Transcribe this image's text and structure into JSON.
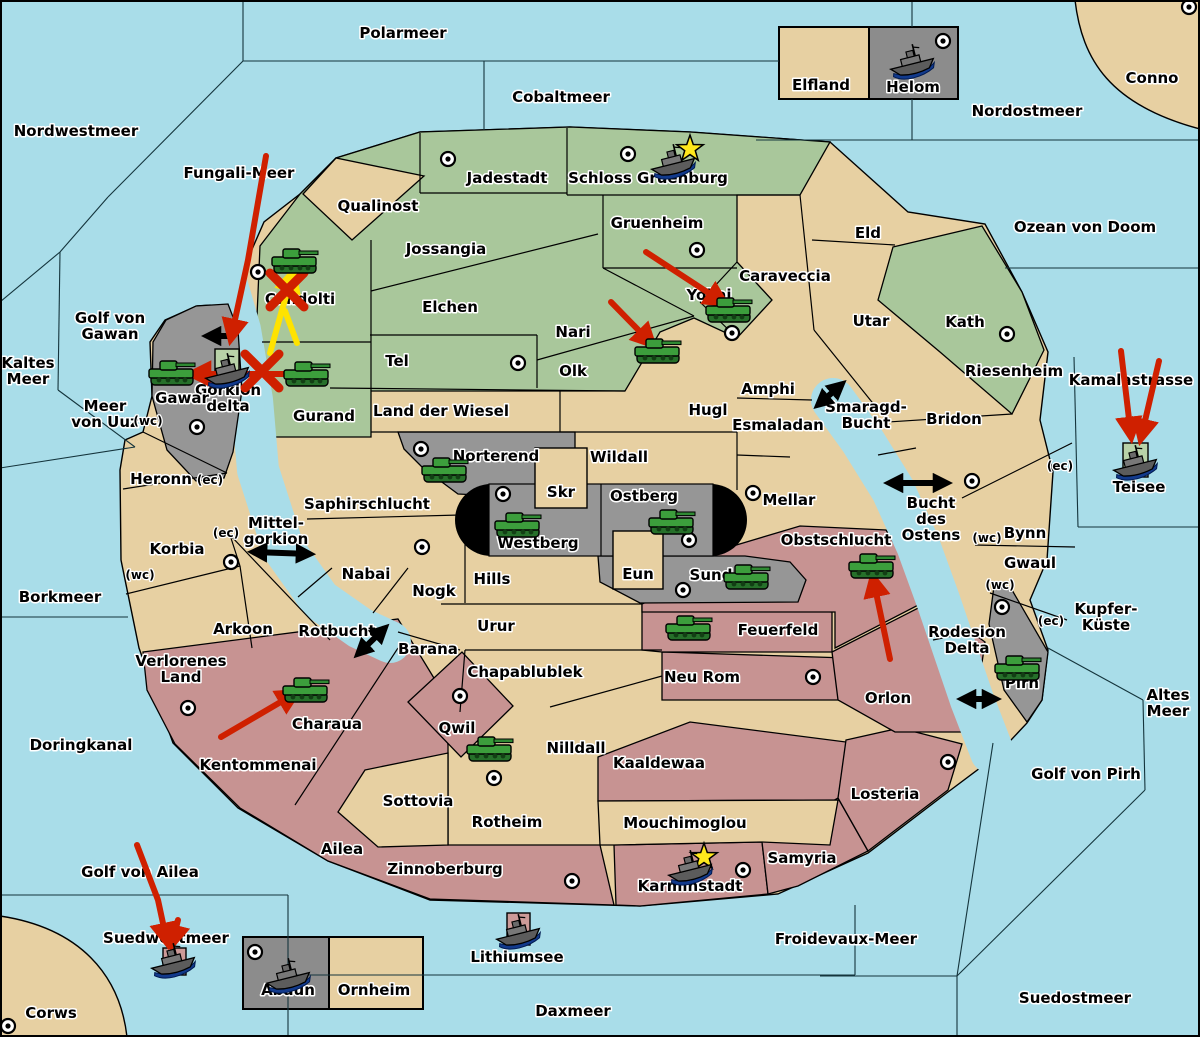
{
  "map": {
    "title": "Diplomacy variant game map",
    "colors": {
      "sea": "#a9dde9",
      "land_tan": "#e7d0a2",
      "land_green": "#a9c79b",
      "land_pink": "#c79392",
      "land_gray": "#969696",
      "inset_gray": "#8c8c8c",
      "box_green": "#b8d2a8",
      "box_pink": "#cc9a98",
      "capsule_black": "#000000",
      "arrow_red": "#cf2000",
      "arrow_yellow": "#ffe300",
      "arrow_black": "#000000",
      "star_yellow": "#ffe81c",
      "unit_green": "#3c9e3c",
      "ship_gray": "#6a6a6a",
      "border": "#000000"
    },
    "sea_labels": [
      {
        "name": "Polarmeer",
        "x": 403,
        "y": 38
      },
      {
        "name": "Cobaltmeer",
        "x": 561,
        "y": 102
      },
      {
        "name": "Nordwestmeer",
        "x": 76,
        "y": 136
      },
      {
        "name": "Nordostmeer",
        "x": 1027,
        "y": 116
      },
      {
        "name": "Fungali-Meer",
        "x": 239,
        "y": 178
      },
      {
        "name": "Ozean von Doom",
        "x": 1085,
        "y": 232
      },
      {
        "name": "Golf von Gawan",
        "x": 110,
        "y": 323,
        "lines": [
          "Golf von",
          "Gawan"
        ]
      },
      {
        "name": "Kaltes Meer",
        "x": 28,
        "y": 368,
        "lines": [
          "Kaltes",
          "Meer"
        ]
      },
      {
        "name": "Meer von Uuz",
        "x": 105,
        "y": 411,
        "lines": [
          "Meer",
          "von Uuz"
        ]
      },
      {
        "name": "Kamalastrasse",
        "x": 1131,
        "y": 385
      },
      {
        "name": "Teisee",
        "x": 1139,
        "y": 492
      },
      {
        "name": "Borkmeer",
        "x": 60,
        "y": 602
      },
      {
        "name": "Mittel-gorkion",
        "x": 276,
        "y": 528,
        "lines": [
          "Mittel-",
          "gorkion"
        ]
      },
      {
        "name": "Smaragd-Bucht",
        "x": 866,
        "y": 412,
        "lines": [
          "Smaragd-",
          "Bucht"
        ]
      },
      {
        "name": "Bucht des Ostens",
        "x": 931,
        "y": 508,
        "lines": [
          "Bucht",
          "des",
          "Ostens"
        ]
      },
      {
        "name": "Rotbucht",
        "x": 337,
        "y": 636
      },
      {
        "name": "Doringkanal",
        "x": 81,
        "y": 750
      },
      {
        "name": "Golf von Pirh",
        "x": 1086,
        "y": 779
      },
      {
        "name": "Kupfer-Kueste",
        "x": 1106,
        "y": 614,
        "lines": [
          "Kupfer-",
          "Küste"
        ]
      },
      {
        "name": "Altes Meer",
        "x": 1168,
        "y": 700,
        "lines": [
          "Altes",
          "Meer"
        ]
      },
      {
        "name": "Golf von Ailea",
        "x": 140,
        "y": 877
      },
      {
        "name": "Suedwestmeer",
        "x": 166,
        "y": 943
      },
      {
        "name": "Froidevaux-Meer",
        "x": 846,
        "y": 944
      },
      {
        "name": "Suedostmeer",
        "x": 1075,
        "y": 1003
      },
      {
        "name": "Daxmeer",
        "x": 573,
        "y": 1016
      },
      {
        "name": "Lithiumsee",
        "x": 517,
        "y": 962
      },
      {
        "name": "Rodesion Delta",
        "x": 967,
        "y": 637,
        "lines": [
          "Rodesion",
          "Delta"
        ]
      },
      {
        "name": "Gorkion delta",
        "x": 228,
        "y": 395,
        "lines": [
          "Gorkion",
          "delta"
        ]
      },
      {
        "name": "Conno",
        "x": 1152,
        "y": 83
      },
      {
        "name": "Corws",
        "x": 51,
        "y": 1018
      }
    ],
    "land_labels": [
      {
        "name": "Jadestadt",
        "x": 507,
        "y": 183
      },
      {
        "name": "Schloss Gruenburg",
        "x": 648,
        "y": 183
      },
      {
        "name": "Qualinost",
        "x": 378,
        "y": 211
      },
      {
        "name": "Jossangia",
        "x": 446,
        "y": 254
      },
      {
        "name": "Elchen",
        "x": 450,
        "y": 312
      },
      {
        "name": "Gruenheim",
        "x": 657,
        "y": 228
      },
      {
        "name": "Nari",
        "x": 573,
        "y": 337
      },
      {
        "name": "Olk",
        "x": 573,
        "y": 376
      },
      {
        "name": "Tel",
        "x": 397,
        "y": 366
      },
      {
        "name": "Yokai",
        "x": 709,
        "y": 300
      },
      {
        "name": "Candolti",
        "x": 300,
        "y": 304
      },
      {
        "name": "Gurand",
        "x": 324,
        "y": 421
      },
      {
        "name": "Kath",
        "x": 965,
        "y": 327
      },
      {
        "name": "Elfland",
        "x": 821,
        "y": 90
      },
      {
        "name": "Helom",
        "x": 913,
        "y": 92
      },
      {
        "name": "Eld",
        "x": 868,
        "y": 238
      },
      {
        "name": "Caraveccia",
        "x": 785,
        "y": 281
      },
      {
        "name": "Utar",
        "x": 871,
        "y": 326
      },
      {
        "name": "Riesenheim",
        "x": 1014,
        "y": 376
      },
      {
        "name": "Bridon",
        "x": 954,
        "y": 424
      },
      {
        "name": "Bynn",
        "x": 1025,
        "y": 538
      },
      {
        "name": "Gwaul",
        "x": 1030,
        "y": 568
      },
      {
        "name": "Amphi",
        "x": 768,
        "y": 394
      },
      {
        "name": "Esmaladan",
        "x": 778,
        "y": 430
      },
      {
        "name": "Hugl",
        "x": 708,
        "y": 415
      },
      {
        "name": "Mellar",
        "x": 789,
        "y": 505
      },
      {
        "name": "Land der Wiesel",
        "x": 441,
        "y": 416
      },
      {
        "name": "Wildall",
        "x": 619,
        "y": 462
      },
      {
        "name": "Skr",
        "x": 561,
        "y": 497
      },
      {
        "name": "Eun",
        "x": 638,
        "y": 579
      },
      {
        "name": "Hills",
        "x": 492,
        "y": 584
      },
      {
        "name": "Nogk",
        "x": 434,
        "y": 596
      },
      {
        "name": "Nabai",
        "x": 366,
        "y": 579
      },
      {
        "name": "Saphirschlucht",
        "x": 367,
        "y": 509
      },
      {
        "name": "Heronn",
        "x": 161,
        "y": 484
      },
      {
        "name": "Korbia",
        "x": 177,
        "y": 554
      },
      {
        "name": "Arkoon",
        "x": 243,
        "y": 634
      },
      {
        "name": "Verlorenes Land",
        "x": 181,
        "y": 666,
        "lines": [
          "Verlorenes",
          "Land"
        ]
      },
      {
        "name": "Barana",
        "x": 428,
        "y": 654
      },
      {
        "name": "Urur",
        "x": 496,
        "y": 631
      },
      {
        "name": "Chapablublek",
        "x": 525,
        "y": 677
      },
      {
        "name": "Nilldall",
        "x": 576,
        "y": 753
      },
      {
        "name": "Sottovia",
        "x": 418,
        "y": 806
      },
      {
        "name": "Ailea",
        "x": 342,
        "y": 854
      },
      {
        "name": "Mouchimoglou",
        "x": 685,
        "y": 828
      },
      {
        "name": "Ornheim",
        "x": 374,
        "y": 995
      },
      {
        "name": "Abaun",
        "x": 288,
        "y": 995
      },
      {
        "name": "Conno-dot-region",
        "x": -100,
        "y": -100
      },
      {
        "name": "Neu Rom",
        "x": 702,
        "y": 682
      },
      {
        "name": "Orlon",
        "x": 888,
        "y": 703
      },
      {
        "name": "Gawar",
        "x": 182,
        "y": 403
      },
      {
        "name": "Norterend",
        "x": 496,
        "y": 461
      },
      {
        "name": "Ostberg",
        "x": 644,
        "y": 501
      },
      {
        "name": "Westberg",
        "x": 538,
        "y": 548
      },
      {
        "name": "Sund",
        "x": 711,
        "y": 580
      },
      {
        "name": "Pirh",
        "x": 1022,
        "y": 688
      },
      {
        "name": "Obstschlucht",
        "x": 836,
        "y": 545
      },
      {
        "name": "Feuerfeld",
        "x": 778,
        "y": 635
      },
      {
        "name": "Kentommenai",
        "x": 258,
        "y": 770
      },
      {
        "name": "Charaua",
        "x": 327,
        "y": 729
      },
      {
        "name": "Qwil",
        "x": 457,
        "y": 733
      },
      {
        "name": "Rotheim",
        "x": 507,
        "y": 827
      },
      {
        "name": "Zinnoberburg",
        "x": 445,
        "y": 874
      },
      {
        "name": "Kaaldewaa",
        "x": 659,
        "y": 768
      },
      {
        "name": "Samyria",
        "x": 802,
        "y": 863
      },
      {
        "name": "Karminstadt",
        "x": 690,
        "y": 891
      },
      {
        "name": "Losteria",
        "x": 885,
        "y": 799
      }
    ],
    "coast_labels": [
      {
        "text": "(wc)",
        "x": 148,
        "y": 425
      },
      {
        "text": "(ec)",
        "x": 210,
        "y": 484
      },
      {
        "text": "(ec)",
        "x": 226,
        "y": 537
      },
      {
        "text": "(wc)",
        "x": 140,
        "y": 579
      },
      {
        "text": "(ec)",
        "x": 1060,
        "y": 470
      },
      {
        "text": "(wc)",
        "x": 987,
        "y": 542
      },
      {
        "text": "(wc)",
        "x": 1000,
        "y": 589
      },
      {
        "text": "(ec)",
        "x": 1051,
        "y": 625
      }
    ],
    "supply_centers": [
      [
        448,
        159
      ],
      [
        628,
        154
      ],
      [
        943,
        41
      ],
      [
        1189,
        7
      ],
      [
        258,
        272
      ],
      [
        518,
        363
      ],
      [
        697,
        250
      ],
      [
        732,
        333
      ],
      [
        1007,
        334
      ],
      [
        972,
        481
      ],
      [
        753,
        493
      ],
      [
        421,
        449
      ],
      [
        503,
        494
      ],
      [
        689,
        540
      ],
      [
        683,
        590
      ],
      [
        422,
        547
      ],
      [
        231,
        562
      ],
      [
        197,
        427
      ],
      [
        188,
        708
      ],
      [
        460,
        696
      ],
      [
        494,
        778
      ],
      [
        572,
        881
      ],
      [
        743,
        870
      ],
      [
        813,
        677
      ],
      [
        948,
        762
      ],
      [
        1002,
        607
      ],
      [
        255,
        952
      ],
      [
        8,
        1026
      ]
    ],
    "units": [
      {
        "type": "army",
        "region": "Candolti",
        "x": 295,
        "y": 261
      },
      {
        "type": "army",
        "region": "Gawar",
        "x": 172,
        "y": 373
      },
      {
        "type": "army",
        "region": "Gurand",
        "x": 307,
        "y": 374
      },
      {
        "type": "army",
        "region": "Yokai",
        "x": 729,
        "y": 310
      },
      {
        "type": "army",
        "region": "Olk",
        "x": 658,
        "y": 351
      },
      {
        "type": "army",
        "region": "Norterend",
        "x": 445,
        "y": 470
      },
      {
        "type": "army",
        "region": "Westberg",
        "x": 518,
        "y": 525
      },
      {
        "type": "army",
        "region": "Ostberg",
        "x": 672,
        "y": 522
      },
      {
        "type": "army",
        "region": "Sund",
        "x": 747,
        "y": 577
      },
      {
        "type": "army",
        "region": "Feuerfeld",
        "x": 689,
        "y": 628
      },
      {
        "type": "army",
        "region": "Obstschlucht",
        "x": 872,
        "y": 566
      },
      {
        "type": "army",
        "region": "Pirh",
        "x": 1018,
        "y": 668
      },
      {
        "type": "army",
        "region": "Charaua",
        "x": 306,
        "y": 690
      },
      {
        "type": "army",
        "region": "Qwil",
        "x": 490,
        "y": 749
      },
      {
        "type": "fleet",
        "region": "Schloss Gruenburg",
        "x": 672,
        "y": 160
      },
      {
        "type": "fleet",
        "region": "Helom",
        "x": 911,
        "y": 60
      },
      {
        "type": "fleet",
        "region": "Gorkion delta",
        "x": 226,
        "y": 369
      },
      {
        "type": "fleet",
        "region": "Teisee",
        "x": 1134,
        "y": 461
      },
      {
        "type": "fleet",
        "region": "Suedwestmeer",
        "x": 172,
        "y": 959
      },
      {
        "type": "fleet",
        "region": "Lithiumsee",
        "x": 517,
        "y": 930
      },
      {
        "type": "fleet",
        "region": "Abaun",
        "x": 287,
        "y": 974
      },
      {
        "type": "fleet",
        "region": "Karminstadt",
        "x": 689,
        "y": 866
      }
    ],
    "move_arrows": [
      {
        "color": "red",
        "points": [
          [
            266,
            156
          ],
          [
            248,
            260
          ],
          [
            231,
            338
          ]
        ]
      },
      {
        "color": "red",
        "points": [
          [
            313,
            374
          ],
          [
            192,
            374
          ]
        ]
      },
      {
        "color": "red",
        "points": [
          [
            646,
            252
          ],
          [
            724,
            303
          ]
        ]
      },
      {
        "color": "red",
        "points": [
          [
            611,
            302
          ],
          [
            652,
            344
          ]
        ]
      },
      {
        "color": "red",
        "points": [
          [
            890,
            659
          ],
          [
            873,
            578
          ]
        ]
      },
      {
        "color": "red",
        "points": [
          [
            221,
            737
          ],
          [
            296,
            693
          ]
        ]
      },
      {
        "color": "red",
        "points": [
          [
            1121,
            351
          ],
          [
            1131,
            436
          ]
        ]
      },
      {
        "color": "red",
        "points": [
          [
            1159,
            361
          ],
          [
            1141,
            438
          ]
        ]
      },
      {
        "color": "red",
        "points": [
          [
            137,
            845
          ],
          [
            158,
            900
          ],
          [
            167,
            942
          ]
        ]
      },
      {
        "color": "red",
        "points": [
          [
            178,
            920
          ],
          [
            172,
            944
          ]
        ]
      },
      {
        "color": "yellow",
        "points": [
          [
            270,
            353
          ],
          [
            282,
            310
          ],
          [
            293,
            273
          ]
        ]
      },
      {
        "color": "yellow",
        "points": [
          [
            297,
            343
          ],
          [
            285,
            311
          ]
        ],
        "nohead": true
      }
    ],
    "fail_marks": [
      [
        287,
        290
      ],
      [
        262,
        371
      ]
    ],
    "strait_arrows": [
      {
        "points": [
          [
            233,
            336
          ],
          [
            207,
            336
          ]
        ],
        "double": false
      },
      {
        "points": [
          [
            253,
            552
          ],
          [
            310,
            554
          ]
        ],
        "double": true
      },
      {
        "points": [
          [
            358,
            654
          ],
          [
            385,
            628
          ]
        ],
        "double": true
      },
      {
        "points": [
          [
            818,
            405
          ],
          [
            842,
            384
          ]
        ],
        "double": true
      },
      {
        "points": [
          [
            889,
            483
          ],
          [
            947,
            483
          ]
        ],
        "double": true
      },
      {
        "points": [
          [
            962,
            699
          ],
          [
            996,
            699
          ]
        ],
        "double": true
      }
    ],
    "stars": [
      [
        690,
        149
      ],
      [
        704,
        857
      ]
    ]
  }
}
